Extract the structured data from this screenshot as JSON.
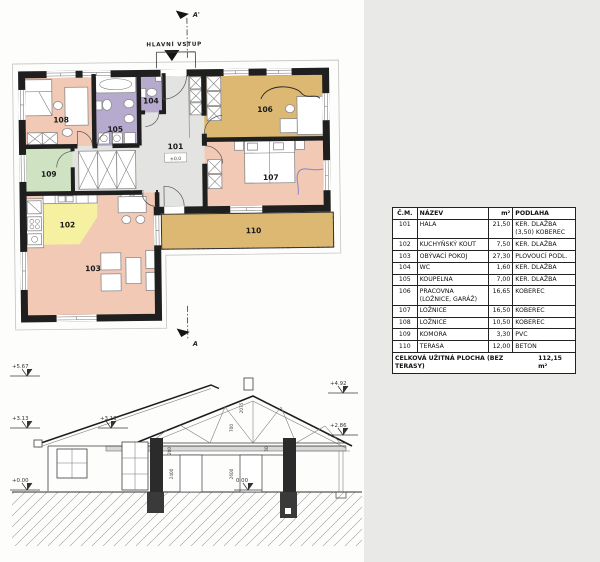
{
  "page": {
    "background": "#fdfdfc",
    "panel_background": "#e9e9e7"
  },
  "plan": {
    "entrance_label": "HLAVNÍ VSTUP",
    "hall_level": "±0,0",
    "section_top": "A'",
    "section_bottom": "A",
    "rooms": [
      {
        "id": "101",
        "color": "#e3e3e2"
      },
      {
        "id": "102",
        "color": "#f6f1a1"
      },
      {
        "id": "103",
        "color": "#f1c9b5"
      },
      {
        "id": "104",
        "color": "#b6abce"
      },
      {
        "id": "105",
        "color": "#b6abce"
      },
      {
        "id": "106",
        "color": "#dcb873"
      },
      {
        "id": "107",
        "color": "#f1c9b5"
      },
      {
        "id": "108",
        "color": "#f1c9b5"
      },
      {
        "id": "109",
        "color": "#cfe3c3"
      },
      {
        "id": "110",
        "color": "#dcb873"
      }
    ]
  },
  "elevation": {
    "levels_left": [
      "+5.67",
      "+3.13",
      "+0.00"
    ],
    "level_mid": "+3.13",
    "levels_right": [
      "+4.92",
      "+2.86"
    ],
    "level_floor": "0.00",
    "dims": {
      "ridge_upper": "2075",
      "ridge_lower": "700",
      "plate": "200",
      "plate2": "50",
      "door_left": "2400",
      "door_right": "2600"
    }
  },
  "table": {
    "headers": [
      "Č.M.",
      "NÁZEV",
      "m²",
      "PODLAHA"
    ],
    "rows": [
      {
        "no": "101",
        "name": "HALA",
        "area": "21,50",
        "floor": "KER. DLAŽBA (3,50) KOBEREC"
      },
      {
        "no": "102",
        "name": "KUCHYŇSKÝ KOUT",
        "area": "7,50",
        "floor": "KER. DLAŽBA"
      },
      {
        "no": "103",
        "name": "OBÝVACÍ POKOJ",
        "area": "27,30",
        "floor": "PLOVOUCÍ PODL."
      },
      {
        "no": "104",
        "name": "WC",
        "area": "1,60",
        "floor": "KER. DLAŽBA"
      },
      {
        "no": "105",
        "name": "KOUPELNA",
        "area": "7,00",
        "floor": "KER. DLAŽBA"
      },
      {
        "no": "106",
        "name": "PRACOVNA (LOŽNICE, GARÁŽ)",
        "area": "16,65",
        "floor": "KOBEREC"
      },
      {
        "no": "107",
        "name": "LOŽNICE",
        "area": "16,50",
        "floor": "KOBEREC"
      },
      {
        "no": "108",
        "name": "LOŽNICE",
        "area": "10,50",
        "floor": "KOBEREC"
      },
      {
        "no": "109",
        "name": "KOMORA",
        "area": "3,30",
        "floor": "PVC"
      },
      {
        "no": "110",
        "name": "TERASA",
        "area": "12,00",
        "floor": "BETON"
      }
    ],
    "footer_label": "CELKOVÁ UŽITNÁ PLOCHA (BEZ TERASY)",
    "footer_value": "112,15 m²"
  }
}
